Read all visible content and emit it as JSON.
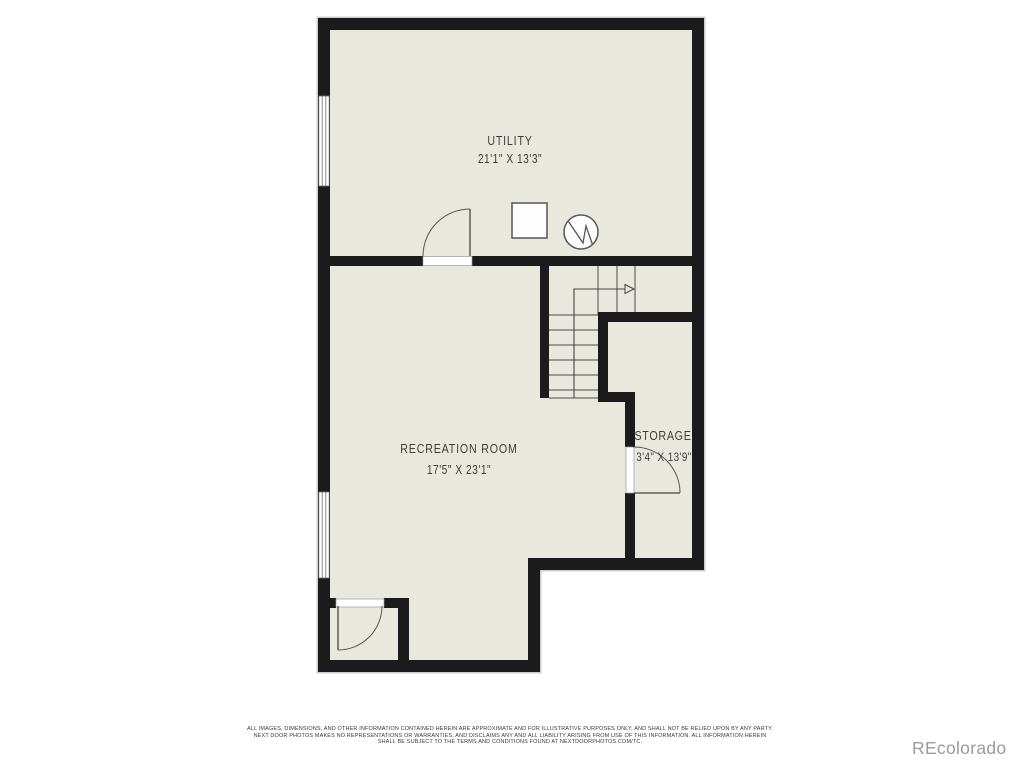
{
  "floorplan": {
    "rooms": [
      {
        "label": "UTILITY",
        "dimensions": "21'1\" X 13'3\""
      },
      {
        "label": "RECREATION ROOM",
        "dimensions": "17'5\" X 23'1\""
      },
      {
        "label": "STORAGE",
        "dimensions": "3'4\" X 13'9\""
      }
    ],
    "colors": {
      "wall": "#1b1b1b",
      "floor": "#e9e8df",
      "label_text": "#3f3e3a",
      "thin_line": "#4a4a4a",
      "halo": "#cdcdc8"
    }
  },
  "footer": {
    "disclaimer": {
      "line1": "ALL IMAGES, DIMENSIONS, AND OTHER INFORMATION CONTAINED HEREIN ARE APPROXIMATE AND FOR ILLUSTRATIVE PURPOSES ONLY, AND SHALL NOT BE RELIED UPON BY ANY PARTY.",
      "line2": "NEXT DOOR PHOTOS MAKES NO REPRESENTATIONS OR WARRANTIES, AND DISCLAIMS ANY AND ALL LIABILITY ARISING FROM USE OF THIS INFORMATION. ALL INFORMATION HEREIN",
      "line3": "SHALL BE SUBJECT TO THE TERMS AND CONDITIONS FOUND AT NEXTDOORPHOTOS.COM/TC."
    },
    "watermark": "REcolorado"
  }
}
